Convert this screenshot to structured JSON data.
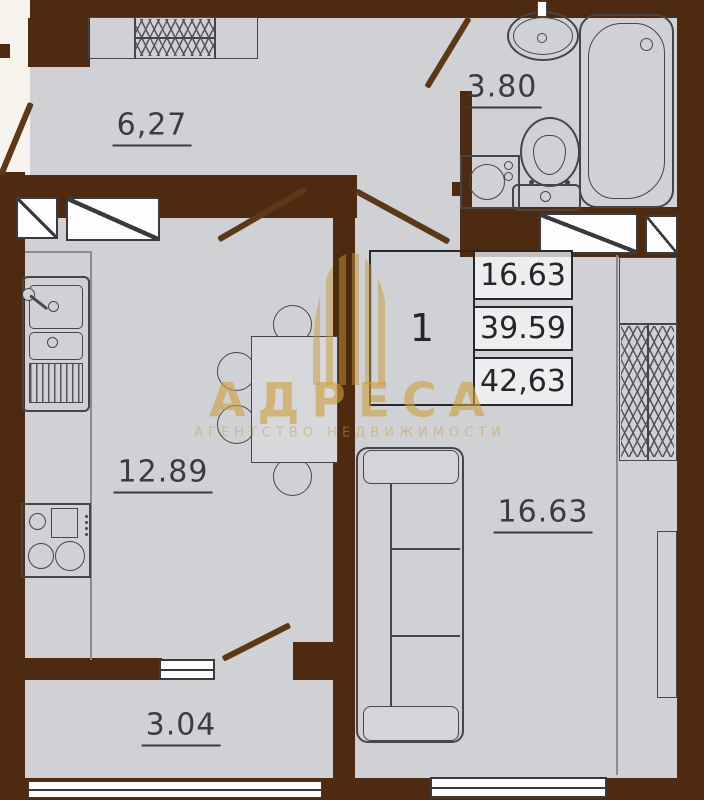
{
  "plan": {
    "type": "apartment-floor-plan",
    "rooms": {
      "hallway": "6,27",
      "bathroom": "3.80",
      "kitchen": "12.89",
      "living": "16.63",
      "balcony": "3.04"
    },
    "info_table": {
      "rooms_count": "1",
      "living_area": "16.63",
      "area_without_balcony": "39.59",
      "total_area": "42,63"
    },
    "watermark": {
      "brand": "АДРЕСА",
      "subtitle": "АГЕНТСТВО НЕДВИЖИМОСТИ"
    },
    "fixtures": [
      "entry-wardrobe",
      "vent-shaft",
      "bath-sink",
      "bathtub",
      "toilet",
      "washing-machine",
      "kitchen-sink",
      "stove",
      "dining-table",
      "chair",
      "sofa",
      "wardrobe",
      "shelf-unit",
      "door-swing",
      "window"
    ],
    "colors": {
      "wall": "#4e2a11",
      "floor": "#d0d1d5",
      "outside": "#f7f4ee",
      "outline": "#46464a",
      "watermark_gold": "#cd9e3e"
    }
  }
}
